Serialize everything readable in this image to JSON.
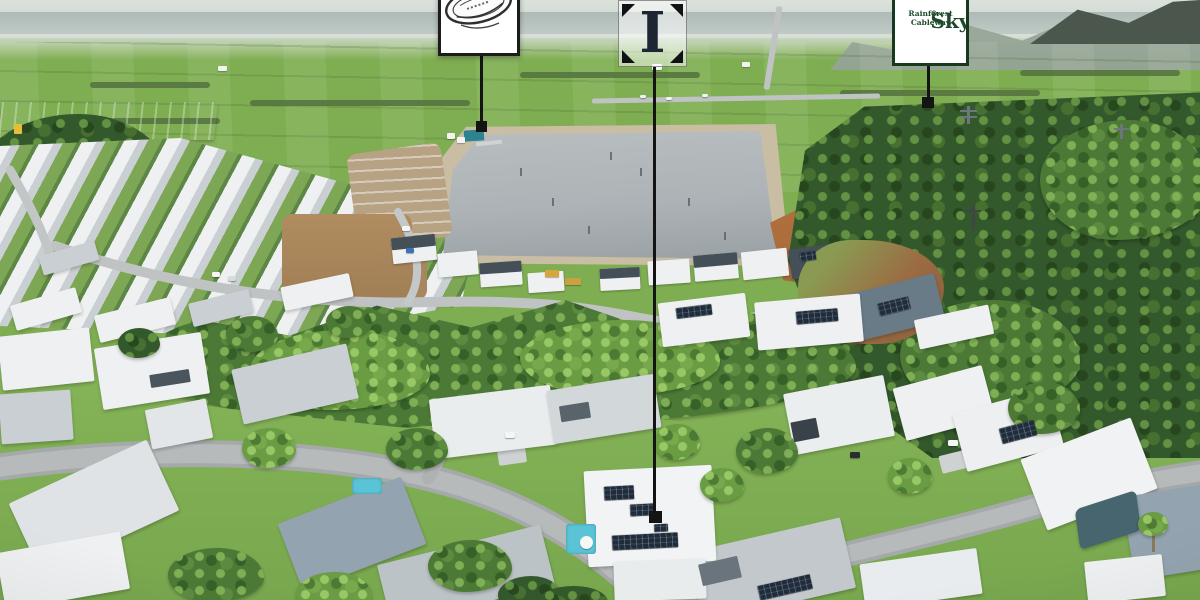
{
  "scene": {
    "type": "aerial-drone-photograph",
    "setting": "lakeside residential estate beside rainforest hills and cane fields with three location callout markers"
  },
  "callouts": {
    "park": {
      "text": "",
      "emblem": "hand-drawn oval emblem, cropped at top of frame"
    },
    "insignia": {
      "letter": "I"
    },
    "skyrail": {
      "title": "Skyrail",
      "registered": "®",
      "subtitle": "Rainforest Cableway"
    }
  },
  "colors": {
    "line": "#141414",
    "box_border": "#1c1c1c",
    "logo_ink": "#1d2733",
    "skyrail_green": "#1e4a2c",
    "skyrail_border": "#173920",
    "sky": "#ccd5d1",
    "sea": "#aebab7",
    "haze": "#dbe1da",
    "field": "#93b268",
    "field_light": "#accd7f",
    "hedge": "#53713f",
    "mountain": "#95a396",
    "mountain_dark": "#4b564c",
    "forest_dark": "#33582b",
    "forest_mid": "#4c7a36",
    "forest_bright": "#6a9c44",
    "lawn": "#7fae52",
    "water": "#adb3b6",
    "sand": "#c9bda3",
    "dirt": "#a8875f",
    "dirt_orange": "#b1713d",
    "road": "#a3a7a8",
    "road_light": "#c0c3c3",
    "roof_white": "#eef0f1",
    "roof_grey": "#c9cfd2",
    "roof_slate": "#93a4b0",
    "roof_dark": "#454f58",
    "solar": "#1f2c3c",
    "pool": "#5ac4d6",
    "warehouse": "#a9b8c2"
  }
}
